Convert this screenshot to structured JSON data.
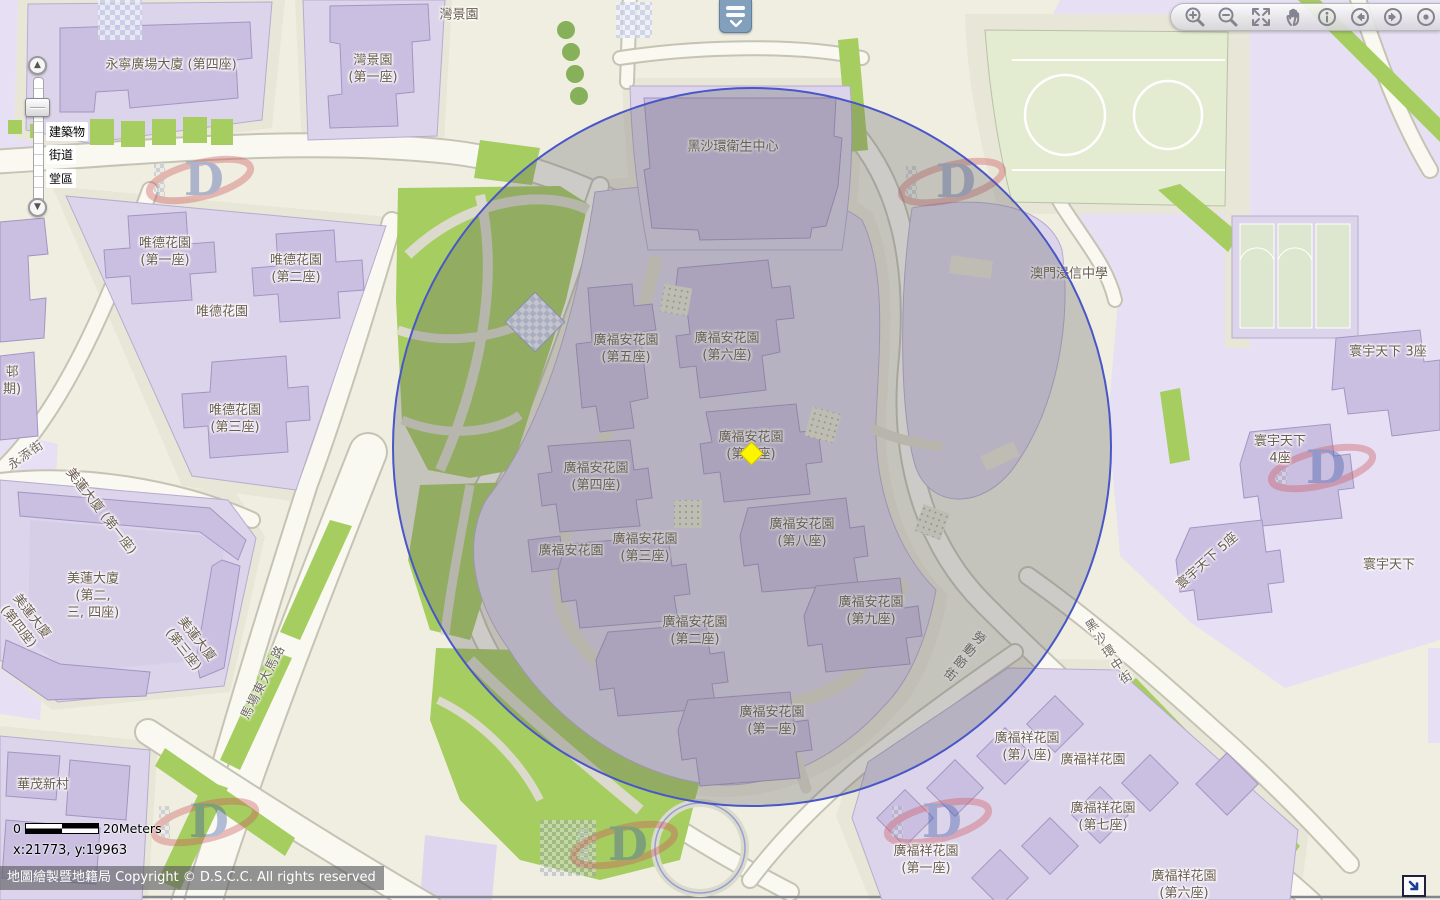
{
  "map": {
    "building_labels": [
      {
        "lines": [
          "永寧廣場大廈 (第四座)"
        ],
        "x": 171,
        "y": 66
      },
      {
        "lines": [
          "灣景園"
        ],
        "x": 459,
        "y": 16
      },
      {
        "lines": [
          "灣景園",
          "(第一座)"
        ],
        "x": 373,
        "y": 70
      },
      {
        "lines": [
          "唯德花園",
          "(第一座)"
        ],
        "x": 165,
        "y": 253
      },
      {
        "lines": [
          "唯德花園",
          "(第二座)"
        ],
        "x": 296,
        "y": 270
      },
      {
        "lines": [
          "唯德花園"
        ],
        "x": 222,
        "y": 313
      },
      {
        "lines": [
          "唯德花園",
          "(第三座)"
        ],
        "x": 235,
        "y": 420
      },
      {
        "lines": [
          "邨",
          "期)"
        ],
        "x": 12,
        "y": 382
      },
      {
        "lines": [
          "美蓮大廈 (第一座)"
        ],
        "x": 100,
        "y": 512,
        "rot": 52
      },
      {
        "lines": [
          "美蓮大廈",
          "(第二,",
          "三, 四座)"
        ],
        "x": 93,
        "y": 597
      },
      {
        "lines": [
          "美蓮大廈",
          "(第四座)"
        ],
        "x": 24,
        "y": 622,
        "rot": 52
      },
      {
        "lines": [
          "美蓮大廈",
          "(第三座)"
        ],
        "x": 189,
        "y": 645,
        "rot": 52
      },
      {
        "lines": [
          "華茂新村"
        ],
        "x": 43,
        "y": 786
      },
      {
        "lines": [
          "黑沙環衛生中心"
        ],
        "x": 733,
        "y": 148
      },
      {
        "lines": [
          "澳門浸信中學"
        ],
        "x": 1069,
        "y": 275
      },
      {
        "lines": [
          "廣福安花園",
          "(第五座)"
        ],
        "x": 626,
        "y": 350
      },
      {
        "lines": [
          "廣福安花園",
          "(第六座)"
        ],
        "x": 727,
        "y": 348
      },
      {
        "lines": [
          "廣福安花園",
          "(第七座)"
        ],
        "x": 751,
        "y": 447
      },
      {
        "lines": [
          "廣福安花園",
          "(第四座)"
        ],
        "x": 596,
        "y": 478
      },
      {
        "lines": [
          "廣福安花園"
        ],
        "x": 571,
        "y": 552
      },
      {
        "lines": [
          "廣福安花園",
          "(第三座)"
        ],
        "x": 645,
        "y": 549
      },
      {
        "lines": [
          "廣福安花園",
          "(第二座)"
        ],
        "x": 695,
        "y": 632
      },
      {
        "lines": [
          "廣福安花園",
          "(第八座)"
        ],
        "x": 802,
        "y": 534
      },
      {
        "lines": [
          "廣福安花園",
          "(第九座)"
        ],
        "x": 871,
        "y": 612
      },
      {
        "lines": [
          "廣福安花園",
          "(第一座)"
        ],
        "x": 772,
        "y": 722
      },
      {
        "lines": [
          "廣福祥花園",
          "(第八座)"
        ],
        "x": 1027,
        "y": 748
      },
      {
        "lines": [
          "廣福祥花園"
        ],
        "x": 1093,
        "y": 761
      },
      {
        "lines": [
          "廣福祥花園",
          "(第七座)"
        ],
        "x": 1103,
        "y": 818
      },
      {
        "lines": [
          "廣福祥花園",
          "(第一座)"
        ],
        "x": 926,
        "y": 861
      },
      {
        "lines": [
          "廣福祥花園",
          "(第六座)"
        ],
        "x": 1184,
        "y": 886
      },
      {
        "lines": [
          "寰宇天下 3座"
        ],
        "x": 1388,
        "y": 353
      },
      {
        "lines": [
          "寰宇天下",
          "4座"
        ],
        "x": 1280,
        "y": 451
      },
      {
        "lines": [
          "寰宇天下 5座"
        ],
        "x": 1208,
        "y": 562,
        "rot": -42
      },
      {
        "lines": [
          "寰宇天下"
        ],
        "x": 1389,
        "y": 566
      }
    ],
    "street_labels": [
      {
        "lines": [
          "永添街"
        ],
        "x": 26,
        "y": 455,
        "rot": -35
      },
      {
        "lines": [
          "馬場東大馬路"
        ],
        "x": 263,
        "y": 682,
        "rot": -63
      },
      {
        "lines": [
          "勞動節街"
        ],
        "x": 963,
        "y": 656,
        "rot": 38,
        "v": true
      },
      {
        "lines": [
          "黑沙環中街"
        ],
        "x": 1108,
        "y": 653,
        "rot": -33,
        "v": true
      }
    ],
    "marker": {
      "x": 751,
      "y": 453,
      "color": "#fdf500"
    },
    "buffer_circle": {
      "cx": 750,
      "cy": 445,
      "r": 358,
      "stroke": "#4856c8"
    }
  },
  "toolbar": {
    "icons": [
      "zoom-in",
      "zoom-out",
      "full-extent",
      "pan-hand",
      "identify-info",
      "previous-extent",
      "next-extent",
      "locate-dot"
    ]
  },
  "legend_tab": {
    "icon": "legend-pulldown"
  },
  "zoom_control": {
    "layer_labels": [
      {
        "label": "建築物",
        "top": 66
      },
      {
        "label": "街道",
        "top": 89
      },
      {
        "label": "堂區",
        "top": 113
      }
    ]
  },
  "scalebar": {
    "zero": "0",
    "label": "20Meters"
  },
  "coords": "x:21773, y:19963",
  "copyright": "地圖繪製暨地籍局 Copyright © D.S.C.C. All rights reserved",
  "colors": {
    "circle_stroke": "#4856c8",
    "marker": "#fdf500",
    "lot": "#dcd4ea",
    "building": "#cabfe0",
    "green": "#a6cd60",
    "lavender": "#e7e0f4"
  }
}
